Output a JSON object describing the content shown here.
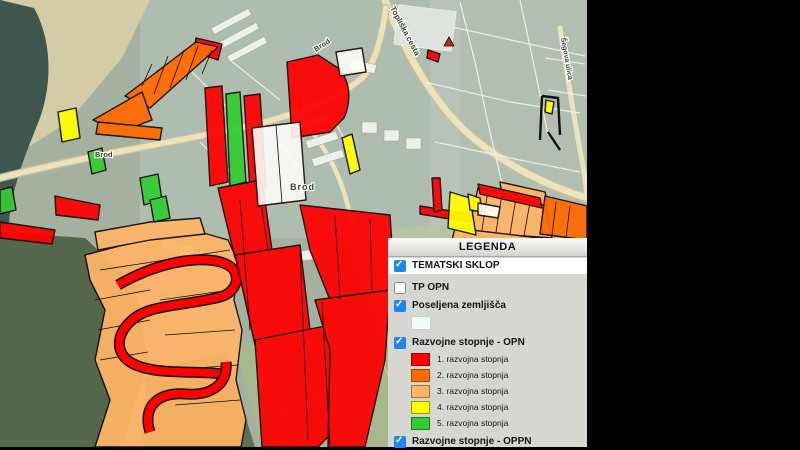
{
  "app": {
    "background": "#000000"
  },
  "legend": {
    "title": "LEGENDA",
    "checkbox_color": "#2186e8",
    "sections": {
      "tematski": {
        "label": "TEMATSKI SKLOP",
        "checked": true
      },
      "tp_opn": {
        "label": "TP OPN",
        "checked": false
      },
      "poseljena": {
        "label": "Poseljena zemljišča",
        "checked": true,
        "swatch_color": "#f2fbfb"
      },
      "opn": {
        "label": "Razvojne stopnje - OPN",
        "checked": true,
        "items": [
          {
            "label": "1. razvojna stopnja",
            "color": "#fe0000",
            "border": "#a80000"
          },
          {
            "label": "2. razvojna stopnja",
            "color": "#ff6a00",
            "border": "#a84400"
          },
          {
            "label": "3. razvojna stopnja",
            "color": "#ffb566",
            "border": "#a87238"
          },
          {
            "label": "4. razvojna stopnja",
            "color": "#ffff00",
            "border": "#9a9a00"
          },
          {
            "label": "5. razvojna stopnja",
            "color": "#33cc33",
            "border": "#1d7d1d"
          }
        ]
      },
      "oppn": {
        "label": "Razvojne stopnje - OPPN",
        "checked": true
      }
    }
  },
  "map": {
    "labels": {
      "settlement_left": "Brod",
      "settlement_center": "Brod",
      "street_brod": "Brod",
      "street_top": "Topliška cesta",
      "street_right": "Šegova ulica"
    },
    "palette": {
      "aerial_base": "#a4b1a0",
      "builtup": "#b6c1b8",
      "river": "#3d574e",
      "riverbank": "#d8cfa6",
      "forest": "#55674a",
      "field": "#a9b98c",
      "road": "#ece3bd",
      "minor_street": "#f5f5ef",
      "building": "#eef0ea",
      "white_parcel": "#fdfdfa",
      "marker_red": "#d81f1f",
      "parcel_outline": "#140a00"
    }
  }
}
